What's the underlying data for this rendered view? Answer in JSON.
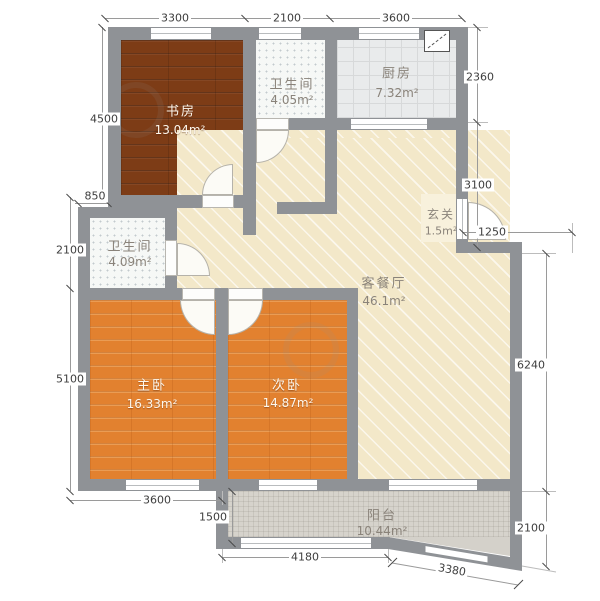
{
  "plan": {
    "title": "residential floor plan",
    "rooms": [
      {
        "id": "study",
        "name": "书房",
        "area": "13.04m²"
      },
      {
        "id": "bath-top",
        "name": "卫生间",
        "area": "4.05m²"
      },
      {
        "id": "kitchen",
        "name": "厨房",
        "area": "7.32m²"
      },
      {
        "id": "entry",
        "name": "玄关",
        "area": "1.5m²"
      },
      {
        "id": "bath-left",
        "name": "卫生间",
        "area": "4.09m²"
      },
      {
        "id": "living",
        "name": "客餐厅",
        "area": "46.1m²"
      },
      {
        "id": "master",
        "name": "主卧",
        "area": "16.33m²"
      },
      {
        "id": "second",
        "name": "次卧",
        "area": "14.87m²"
      },
      {
        "id": "balcony",
        "name": "阳台",
        "area": "10.44m²"
      }
    ],
    "dimensions": {
      "top": [
        "3300",
        "2100",
        "3600"
      ],
      "left": [
        "4500",
        "850",
        "2100",
        "5100"
      ],
      "right": [
        "2360",
        "3100",
        "1250",
        "6240",
        "2100"
      ],
      "bottom": [
        "3600",
        "1500",
        "4180",
        "3380"
      ]
    },
    "colors": {
      "wall": "#8f9296",
      "study_floor": "#7d3c16",
      "bedroom_floor": "#e2812f",
      "living_floor": "#f3e8c9",
      "kitchen_floor": "#e9ebec",
      "bath_floor": "#f6f8f6",
      "balcony_floor": "#d6d3cc",
      "entry_floor": "#f8f1dc"
    }
  }
}
